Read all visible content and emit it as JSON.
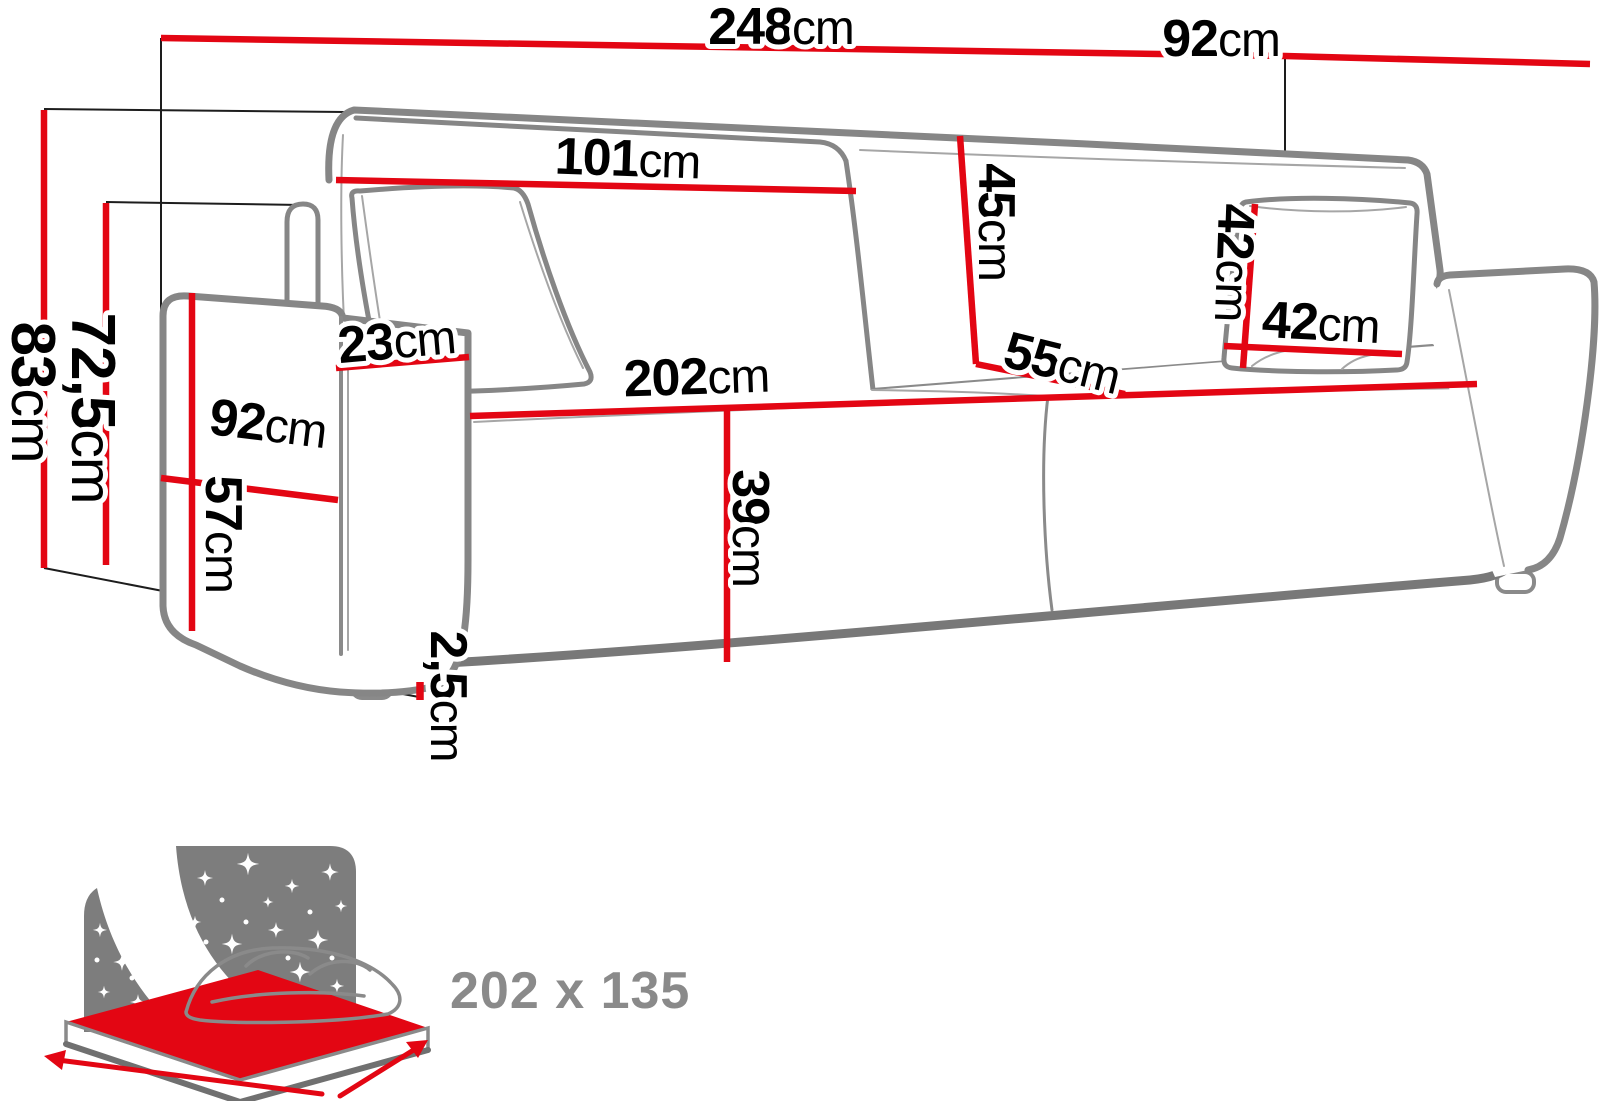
{
  "diagram": {
    "type": "sofa-bed dimension drawing",
    "units": "cm",
    "colors": {
      "dimension_line_red": "#e30613",
      "outline_gray": "#868686",
      "text_black": "#000000",
      "sleeping_label_gray": "#8a8a8a"
    },
    "dims": {
      "total_width": {
        "num": "248",
        "unit": "cm"
      },
      "total_depth": {
        "num": "92",
        "unit": "cm"
      },
      "back_cushion_width": {
        "num": "101",
        "unit": "cm"
      },
      "back_cushion_height": {
        "num": "45",
        "unit": "cm"
      },
      "pillow_height": {
        "num": "42",
        "unit": "cm"
      },
      "pillow_width": {
        "num": "42",
        "unit": "cm"
      },
      "seat_depth": {
        "num": "55",
        "unit": "cm"
      },
      "armrest_top_width": {
        "num": "23",
        "unit": "cm"
      },
      "side_depth": {
        "num": "92",
        "unit": "cm"
      },
      "seat_width": {
        "num": "202",
        "unit": "cm"
      },
      "seat_height": {
        "num": "39",
        "unit": "cm"
      },
      "armrest_height": {
        "num": "57",
        "unit": "cm"
      },
      "leg_clearance": {
        "num": "2,5",
        "unit": "cm"
      },
      "total_height": {
        "num": "83",
        "unit": "cm"
      },
      "back_height": {
        "num": "72,5",
        "unit": "cm"
      }
    },
    "sleeping_area": {
      "size": "202 x 135"
    }
  }
}
